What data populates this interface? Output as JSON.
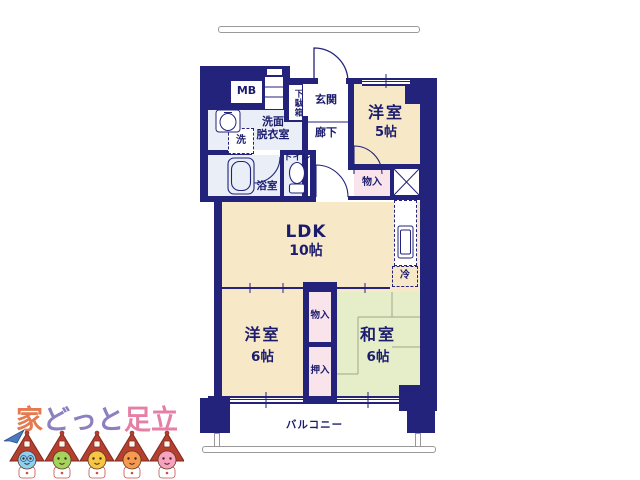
{
  "plan": {
    "colors": {
      "wall": "#23237b",
      "text": "#1c1c6e",
      "cream": "#f7e9c8",
      "green": "#e5edc9",
      "pink": "#fae4ec",
      "wet": "#e9eef7",
      "tatami": "#a0a88a",
      "balcony_line": "#999999"
    },
    "labels": {
      "mb": "MB",
      "getabako": "下駄箱",
      "genkan": "玄関",
      "rouka": "廊下",
      "senmen_line1": "洗面",
      "senmen_line2": "脱衣室",
      "laundry": "洗",
      "bath": "浴室",
      "toilet": "トイレ",
      "yoshitsu5_name": "洋室",
      "yoshitsu5_size": "5帖",
      "monoire_upper": "物入",
      "ldk_name": "LDK",
      "ldk_size": "10帖",
      "fridge": "冷",
      "yoshitsu6_name": "洋室",
      "yoshitsu6_size": "6帖",
      "monoire_lower": "物入",
      "oshiire": "押入",
      "washitsu_name": "和室",
      "washitsu_size": "6帖",
      "balcony": "バルコニー"
    }
  },
  "logo": {
    "part1": "家",
    "part2": "どっと",
    "part3": "足立",
    "colors": {
      "part1": "#e5794f",
      "part2": "#8d80c0",
      "part3": "#e57fa6",
      "roof": "#b5402f",
      "roof_outline": "#7e2a1e"
    },
    "mascot_faces": [
      "#8fd0f0",
      "#a6d35e",
      "#f5c545",
      "#f59a50",
      "#f7a3c0"
    ]
  }
}
